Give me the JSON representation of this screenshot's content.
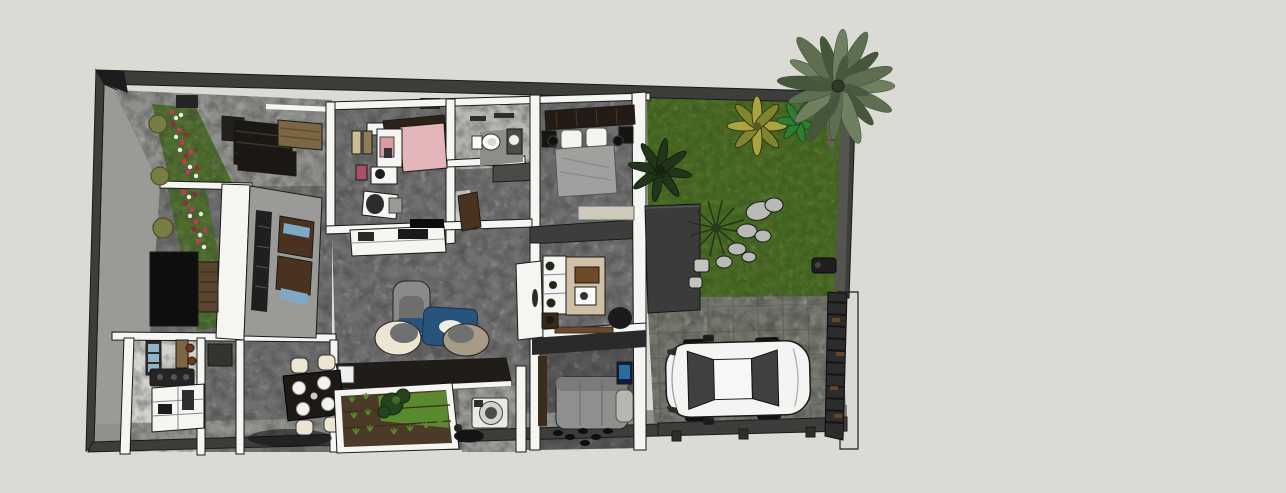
{
  "viewport": {
    "kind": "3d-floorplan-render",
    "width_px": 1286,
    "height_px": 493
  },
  "colors": {
    "background": "#d9dbd4",
    "outline": "#1a1a1a",
    "wallDark": "#3d3d3c",
    "wallFace": "#9a9b96",
    "wallWhite": "#f5f5f2",
    "floorCarpet": "#707070",
    "floorLight": "#d2d2ce",
    "terraceFloor": "#8f908b",
    "walkway": "#90918c",
    "tileBase": "#73776c",
    "tileGrout": "#5c6055",
    "grass": "#41601f",
    "hedge": "#4a692c",
    "soil": "#4b3a28",
    "cropGreen": "#5a8a2e",
    "flowerRed": "#c23b52",
    "flowerWhite": "#f2eee6",
    "bedPink": "#e4b6ba",
    "sofaBlue": "#27537d",
    "sofaCream": "#ece5d2",
    "sofaTaupe": "#a79a87",
    "grayChair": "#8a8a88",
    "woodTable": "#7c6644",
    "woodDark": "#5a4630",
    "doorBrown": "#4a3220",
    "glassBlue": "#7fa9c4",
    "deskTan": "#cfc0a6",
    "blanketGray": "#a0a09e",
    "furnitureDark": "#1b1813",
    "carBody": "#f4f4f2",
    "carGlass": "#404040",
    "gateDark": "#2c2c2c",
    "rustAccent": "#6e4a26",
    "palmLight": "#6e8060",
    "palmMid": "#5d6e53",
    "palmDark": "#46563d",
    "stone": "#b9b9b5",
    "tvScreen": "#2c6aa0",
    "slabDark": "#3b3b3b",
    "guestSofa": "#8f8f8d"
  }
}
